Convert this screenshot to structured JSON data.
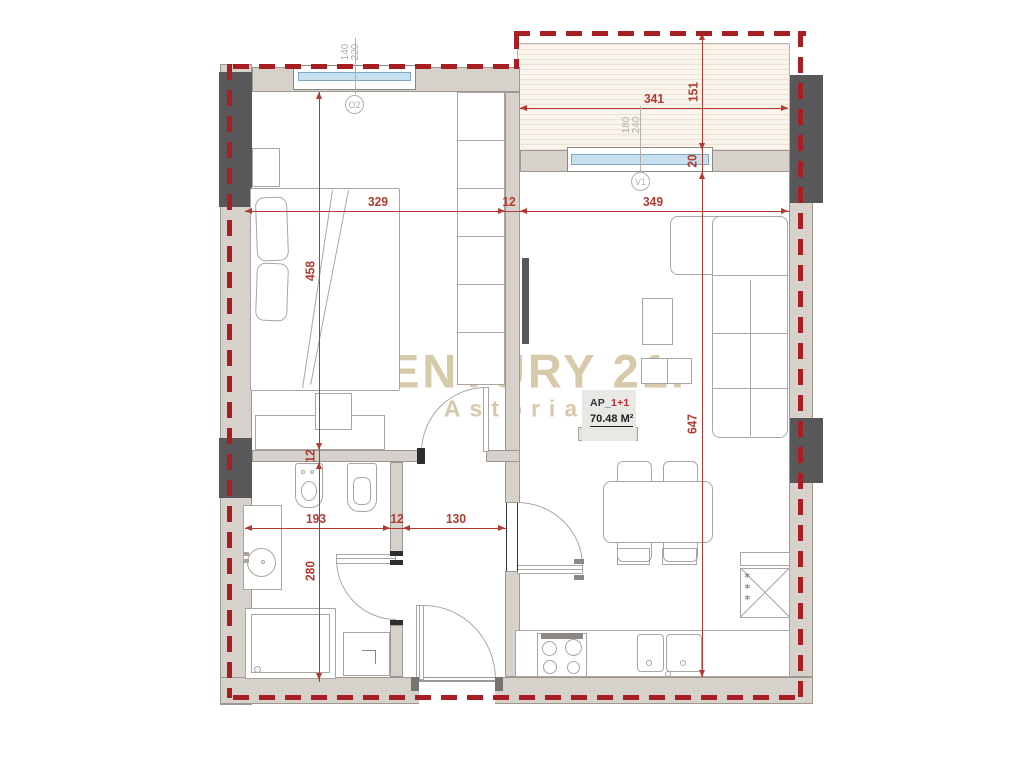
{
  "plan": {
    "watermark": {
      "brand": "CENTURY 21.",
      "office": "Astoria"
    },
    "title_block": {
      "prefix": "AP_",
      "unit": "1+1",
      "area": "70.48 M²"
    },
    "window_tags": {
      "o2": {
        "id": "O2",
        "size_w": "140",
        "size_h": "220"
      },
      "v1": {
        "id": "V1",
        "size_w": "180",
        "size_h": "240"
      }
    },
    "dims": {
      "bedroom_w": "329",
      "wall_top": "12",
      "living_w": "349",
      "bedroom_d": "458",
      "wall_mid": "12",
      "bath_d": "280",
      "bath_w": "193",
      "wall_bath": "12",
      "hall_w": "130",
      "balcony_w": "341",
      "balcony_d": "151",
      "parapet": "20",
      "living_d": "647"
    },
    "icons": {
      "freezer_marks": "*\n*\n*"
    }
  },
  "colors": {
    "boundary_red": "#a81e22",
    "dim_red": "#b43a31",
    "wall_gray": "#d6d2cb",
    "column_dark": "#58585a",
    "window_blue": "#c6e0ee",
    "watermark_beige": "#d6caab",
    "tag_gray": "#b2afac",
    "title_red": "#c2272d",
    "balcony_cream": "#faf5ec"
  }
}
